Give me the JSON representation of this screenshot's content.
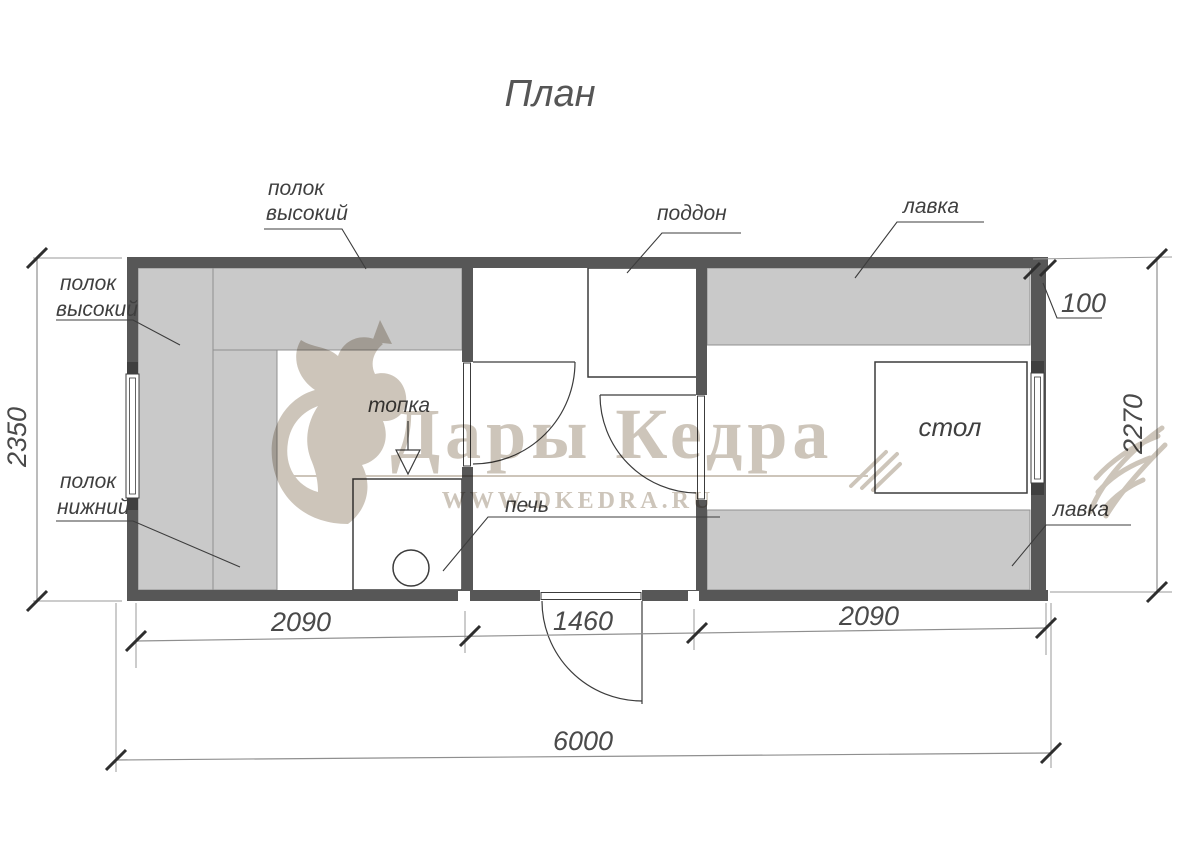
{
  "title": "План",
  "watermark": {
    "brand": "Дары Кедра",
    "website": "WWW.DKEDRA.RU"
  },
  "rooms": {
    "steam_room": {
      "shelf_high_top_label": {
        "line1": "полок",
        "line2": "высокий"
      },
      "shelf_high_left_label": {
        "line1": "полок",
        "line2": "высокий"
      },
      "shelf_low_label": {
        "line1": "полок",
        "line2": "нижний"
      },
      "firebox_label": "топка",
      "stove_label": "печь"
    },
    "washing_room": {
      "tray_label": "поддон"
    },
    "rest_room": {
      "bench_top_label": "лавка",
      "bench_bottom_label": "лавка",
      "table_label": "стол"
    }
  },
  "dimensions": {
    "steam_room_width": "2090",
    "washing_room_width": "1460",
    "rest_room_width": "2090",
    "total_width": "6000",
    "left_height": "2350",
    "right_height": "2270",
    "wall_thickness": "100"
  },
  "colors": {
    "wall": "#575757",
    "bench_fill": "#c9c9c9",
    "drawing_line": "#3c3c3c",
    "dimension_line": "#8f8f8f",
    "watermark": "#cdc5ba"
  }
}
